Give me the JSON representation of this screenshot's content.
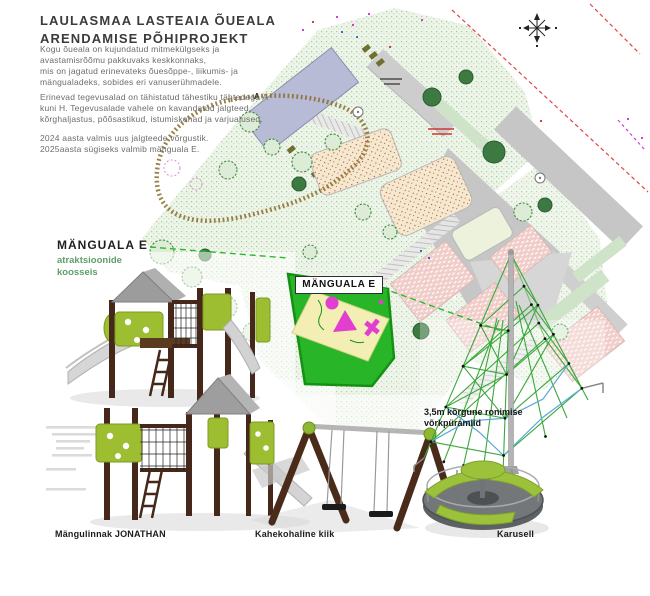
{
  "header": {
    "title_line1": "LAULASMAA LASTEAIA ÕUEALA",
    "title_line2": "ARENDAMISE PÕHIPROJEKT",
    "paragraph1": "Kogu õueala on kujundatud mitmekülgseks ja\navastamisrõõmu pakkuvaks keskkonnaks,\nmis on jagatud erinevateks õuesõppe-, liikumis- ja\nmängualadeks, sobides eri vanuserühmadele.",
    "paragraph2": "Erinevad tegevusalad on tähistatud tähestiku tähtedega A\nkuni H. Tegevusalade vahele on kavandatud jalgteed,\nkõrghaljastus, põõsastikud, istumiskohad ja varjualused.",
    "paragraph3": "2024 aasta valmis uus jalgteede võrgustik.\n2025aasta sügiseks valmib mänguala E."
  },
  "plan": {
    "area_e_label": "MÄNGUALA E",
    "area_letter": "A",
    "compass_icon": "north-compass"
  },
  "callouts": {
    "area_e_title": "MÄNGUALA E",
    "area_e_subtitle": "atraktsioonide\nkoosseis",
    "pyramid_note": "3,5m kõrgune ronimise\nvõrkpüramiid"
  },
  "equipment_labels": {
    "playhouse": "Mängulinnak JONATHAN",
    "swing": "Kahekohaline kiik",
    "carousel": "Karusell"
  },
  "colors": {
    "highlight_green": "#28b628",
    "equipment_lime": "#9cbe30",
    "wood_brown": "#45281a",
    "magenta_accent": "#e23fd0",
    "callout_subtitle_green": "#5f9e6a"
  }
}
